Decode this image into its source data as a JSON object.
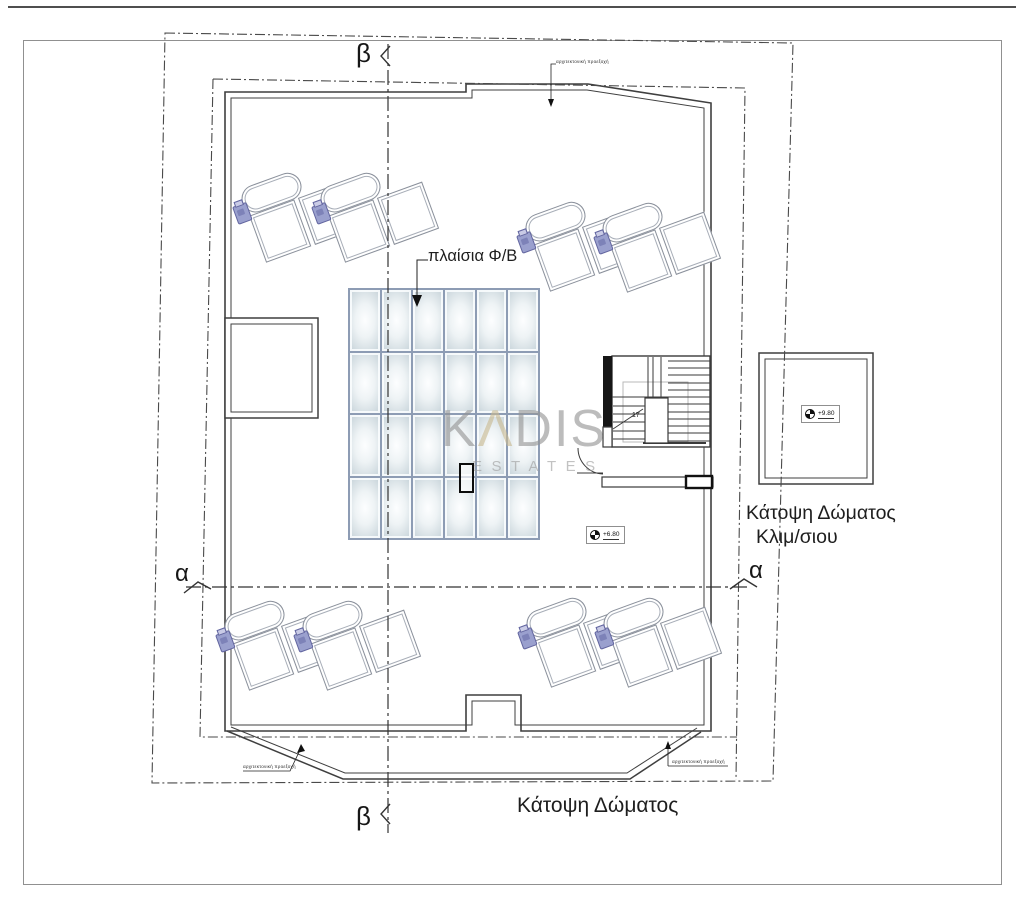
{
  "page": {
    "plan_title": "Κάτοψη Δώματος",
    "stair_roof_plan_title_line1": "Κάτοψη Δώματος",
    "stair_roof_plan_title_line2": "Κλιμ/σιου",
    "pv_panels_label": "πλαίσια Φ/Β",
    "projection_note": "αρχιτεκτονική προεξοχή",
    "section_marker_alpha": "α",
    "section_marker_beta": "β",
    "elevation_roof": "+6.80",
    "elevation_stair_roof": "+9.80",
    "stair_steps_count": "17"
  },
  "watermark": {
    "wordmark": "KADIS",
    "wordmark_k": "K",
    "wordmark_a": "Λ",
    "wordmark_rest": "DIS",
    "subtitle": "ESTATES"
  },
  "pv_grid": {
    "rows": 4,
    "columns": 6
  },
  "colors": {
    "panel_border": "#8d9cb4",
    "panel_fill_edge": "#c9d5db",
    "pump_purple": "#9aa0ce",
    "watermark_gray": "#949494",
    "watermark_accent": "#c9ba92",
    "line_dark": "#3f3f3f"
  }
}
